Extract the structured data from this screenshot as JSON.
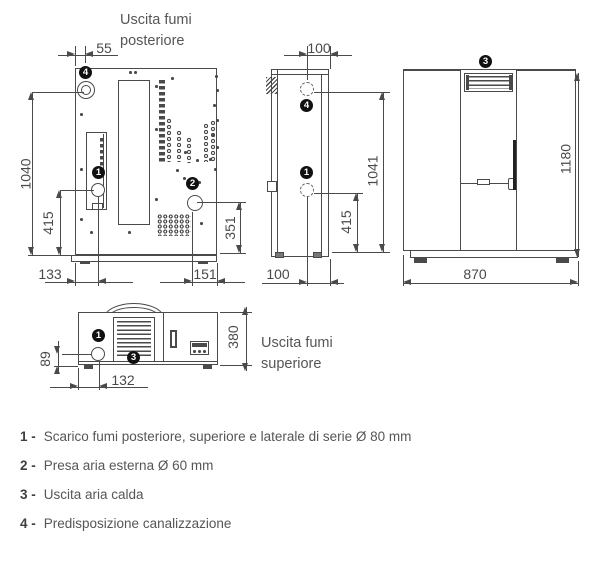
{
  "colors": {
    "line": "#4a4a4a",
    "text": "#55565a",
    "marker_bg": "#111111",
    "background": "#ffffff"
  },
  "views": {
    "rear": {
      "title_line1": "Uscita fumi",
      "title_line2": "posteriore",
      "dims": {
        "flue_offset": "55",
        "height": "1040",
        "flue_height": "415",
        "base_left": "133",
        "base_right": "151",
        "air_height": "351"
      }
    },
    "side": {
      "dims": {
        "depth_top": "100",
        "height": "1041",
        "flue_height": "415",
        "depth_bottom": "100"
      }
    },
    "front": {
      "dims": {
        "height": "1180",
        "width": "870"
      }
    },
    "top": {
      "title_line1": "Uscita fumi",
      "title_line2": "superiore",
      "dims": {
        "flue_offset_y": "89",
        "depth": "380",
        "flue_offset_x": "132"
      }
    }
  },
  "markers": {
    "m1": "1",
    "m2": "2",
    "m3": "3",
    "m4": "4"
  },
  "legend": [
    {
      "prefix": "1 -",
      "text": "Scarico fumi posteriore, superiore e laterale di serie Ø 80 mm"
    },
    {
      "prefix": "2 -",
      "text": "Presa aria esterna Ø 60 mm"
    },
    {
      "prefix": "3 -",
      "text": "Uscita aria calda"
    },
    {
      "prefix": "4 -",
      "text": "Predisposizione canalizzazione"
    }
  ]
}
